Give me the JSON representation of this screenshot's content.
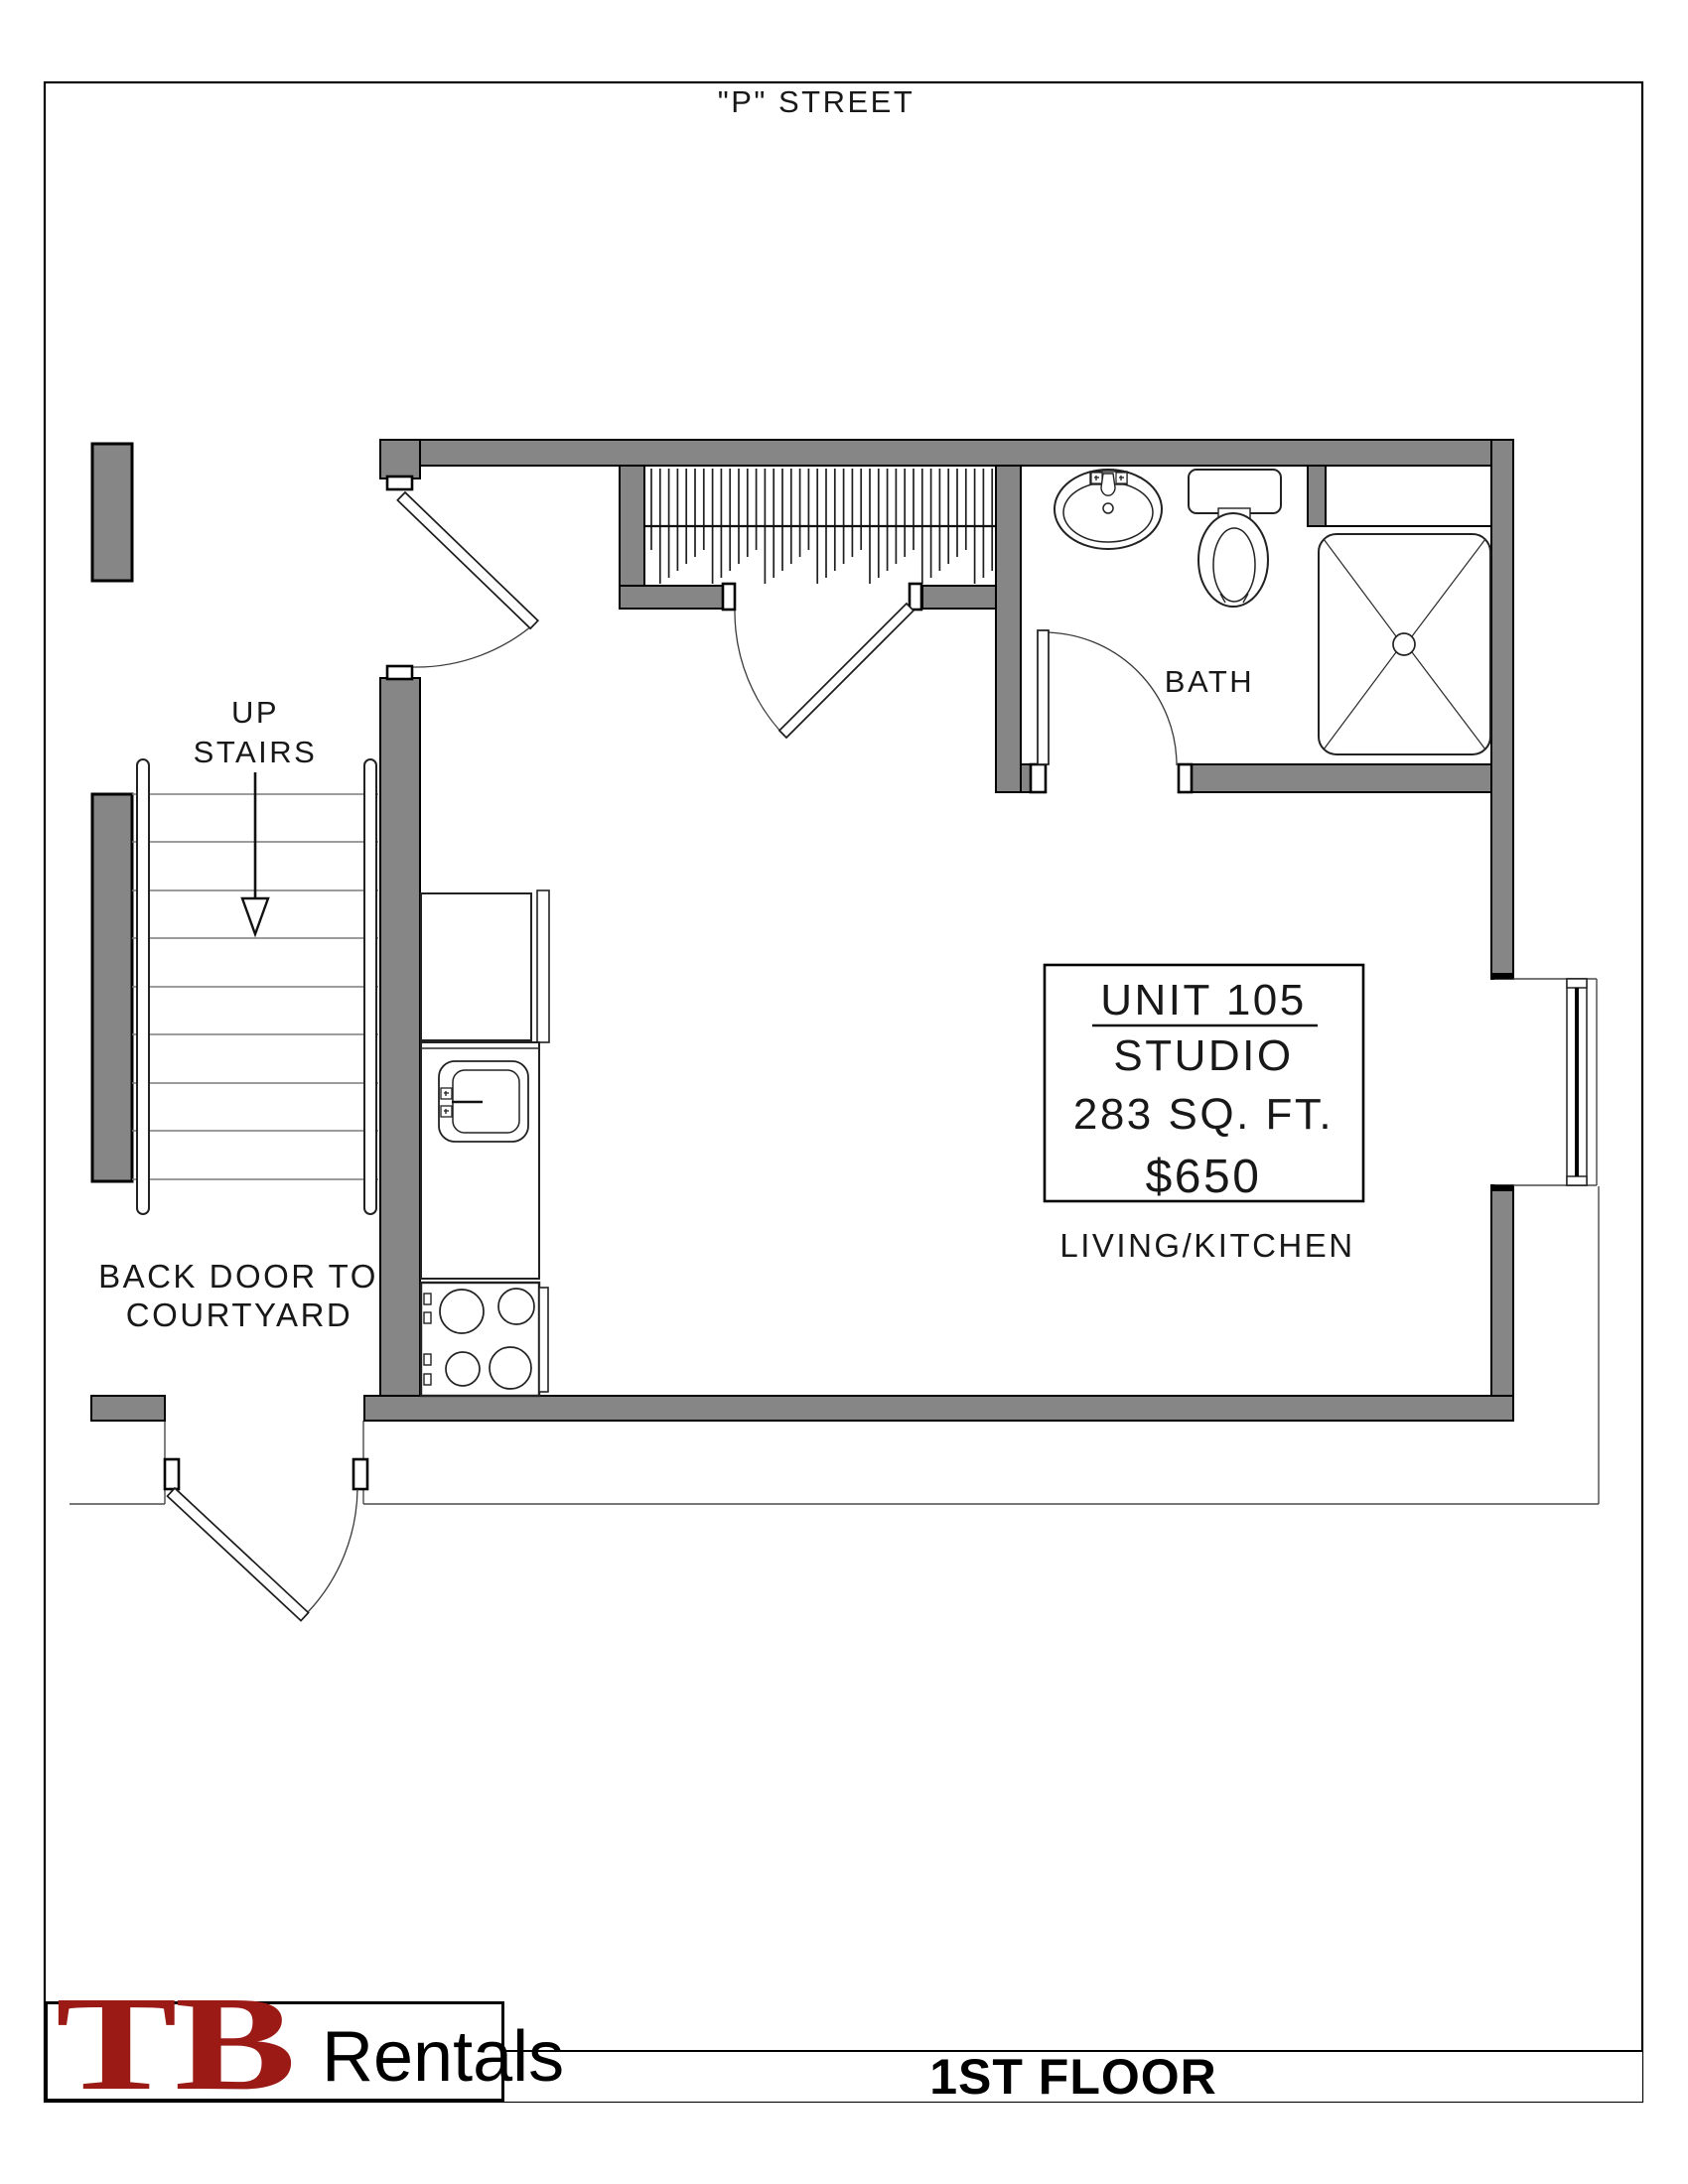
{
  "page": {
    "street_label": "\"P\" STREET",
    "floor_title": "1ST FLOOR"
  },
  "logo": {
    "initials": "TB",
    "suffix": "Rentals"
  },
  "rooms": {
    "bath": "BATH",
    "living_kitchen": "LIVING/KITCHEN"
  },
  "stairs_label": {
    "line1": "UP",
    "line2": "STAIRS"
  },
  "back_door_label": {
    "line1": "BACK DOOR TO",
    "line2": "COURTYARD"
  },
  "unit_info": {
    "unit": "UNIT 105",
    "type": "STUDIO",
    "area": "283 SQ. FT.",
    "price": "$650"
  },
  "colors": {
    "wall_fill": "#868686",
    "outline": "#000000",
    "logo_red": "#9b1a15",
    "tread_line": "#7b7b7b"
  }
}
